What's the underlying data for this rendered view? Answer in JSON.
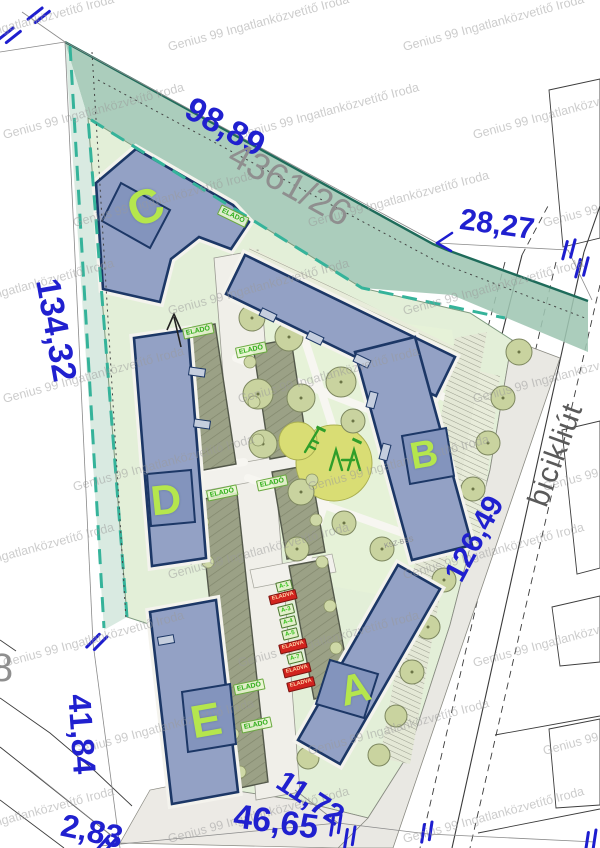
{
  "plan": {
    "type": "residential development site plan",
    "watermark_text": "Genius 99 Ingatlanközvetítő Iroda"
  },
  "colors": {
    "dimension_blue": "#2020cf",
    "building_letter_green": "#b5e64d",
    "elado_green": "#2fae19",
    "eladva_red": "#d2231e",
    "boundary_teal": "#35b39a",
    "parcel_gray": "#8f8f8f",
    "building_fill": "#93a1c5",
    "building_outline": "#1c3766"
  },
  "watermark": {
    "text": "Genius 99 Ingatlanközvetítő Iroda",
    "layout": {
      "rows": 10,
      "cols": 3,
      "x0": -30,
      "y0": 16,
      "dx": 235,
      "dy": 88,
      "row_shift": 70,
      "rot": -15
    }
  },
  "dimensions": [
    {
      "id": "98-89",
      "text": "98,89",
      "x": 225,
      "y": 127,
      "rot": 29,
      "size": 34
    },
    {
      "id": "28-27",
      "text": "28,27",
      "x": 497,
      "y": 225,
      "rot": 8,
      "size": 30
    },
    {
      "id": "134-32",
      "text": "134,32",
      "x": 56,
      "y": 330,
      "rot": 80,
      "size": 34
    },
    {
      "id": "126-49",
      "text": "126,49",
      "x": 475,
      "y": 539,
      "rot": -62,
      "size": 30
    },
    {
      "id": "41-84",
      "text": "41,84",
      "x": 82,
      "y": 734,
      "rot": 86,
      "size": 32
    },
    {
      "id": "2-83",
      "text": "2,83",
      "x": 92,
      "y": 831,
      "rot": 12,
      "size": 32
    },
    {
      "id": "46-65",
      "text": "46,65",
      "x": 276,
      "y": 822,
      "rot": 8,
      "size": 34
    },
    {
      "id": "11-72",
      "text": "11,72",
      "x": 310,
      "y": 799,
      "rot": 33,
      "size": 30
    }
  ],
  "gray_labels": [
    {
      "id": "parcel-number",
      "text": "4361/26",
      "x": 290,
      "y": 184,
      "rot": 29,
      "size": 37,
      "cls": "gray"
    },
    {
      "id": "street-name",
      "text": "bicikliút",
      "x": 556,
      "y": 455,
      "rot": -70,
      "size": 30,
      "cls": "street"
    },
    {
      "id": "partial-parcel-digit",
      "text": "8",
      "x": 2,
      "y": 668,
      "rot": 0,
      "size": 40,
      "cls": "gray"
    },
    {
      "id": "plan-note",
      "text": "KSZ-BSS",
      "x": 399,
      "y": 543,
      "rot": -14,
      "size": 7,
      "cls": "gray"
    }
  ],
  "buildings": [
    {
      "id": "a",
      "letter": "A",
      "x": 355,
      "y": 689,
      "rot": -14,
      "size": 42
    },
    {
      "id": "b",
      "letter": "B",
      "x": 424,
      "y": 455,
      "rot": -10,
      "size": 38
    },
    {
      "id": "c",
      "letter": "C",
      "x": 146,
      "y": 208,
      "rot": -24,
      "size": 48
    },
    {
      "id": "d",
      "letter": "D",
      "x": 166,
      "y": 500,
      "rot": -6,
      "size": 42
    },
    {
      "id": "e",
      "letter": "E",
      "x": 206,
      "y": 720,
      "rot": -10,
      "size": 46
    }
  ],
  "sale": {
    "elado_text": "ELADÓ",
    "eladva_text": "ELADVA",
    "elado_chips": [
      {
        "x": 233,
        "y": 216,
        "rot": 26
      },
      {
        "x": 198,
        "y": 331,
        "rot": -12
      },
      {
        "x": 251,
        "y": 350,
        "rot": -12
      },
      {
        "x": 222,
        "y": 493,
        "rot": -12
      },
      {
        "x": 272,
        "y": 483,
        "rot": -12
      },
      {
        "x": 249,
        "y": 687,
        "rot": -12
      },
      {
        "x": 256,
        "y": 725,
        "rot": -12
      }
    ],
    "unit_chips": [
      {
        "text": "A-1",
        "status": "available",
        "x": 284,
        "y": 586
      },
      {
        "text": "ELADVA",
        "status": "sold",
        "x": 283,
        "y": 597
      },
      {
        "text": "A-3",
        "status": "available",
        "x": 286,
        "y": 610
      },
      {
        "text": "A-4",
        "status": "available",
        "x": 288,
        "y": 622
      },
      {
        "text": "A-5",
        "status": "available",
        "x": 290,
        "y": 634
      },
      {
        "text": "ELADVA",
        "status": "sold",
        "x": 293,
        "y": 646
      },
      {
        "text": "A-7",
        "status": "available",
        "x": 295,
        "y": 658
      },
      {
        "text": "ELADVA",
        "status": "sold",
        "x": 297,
        "y": 670
      },
      {
        "text": "ELADVA",
        "status": "sold",
        "x": 301,
        "y": 684
      }
    ]
  }
}
